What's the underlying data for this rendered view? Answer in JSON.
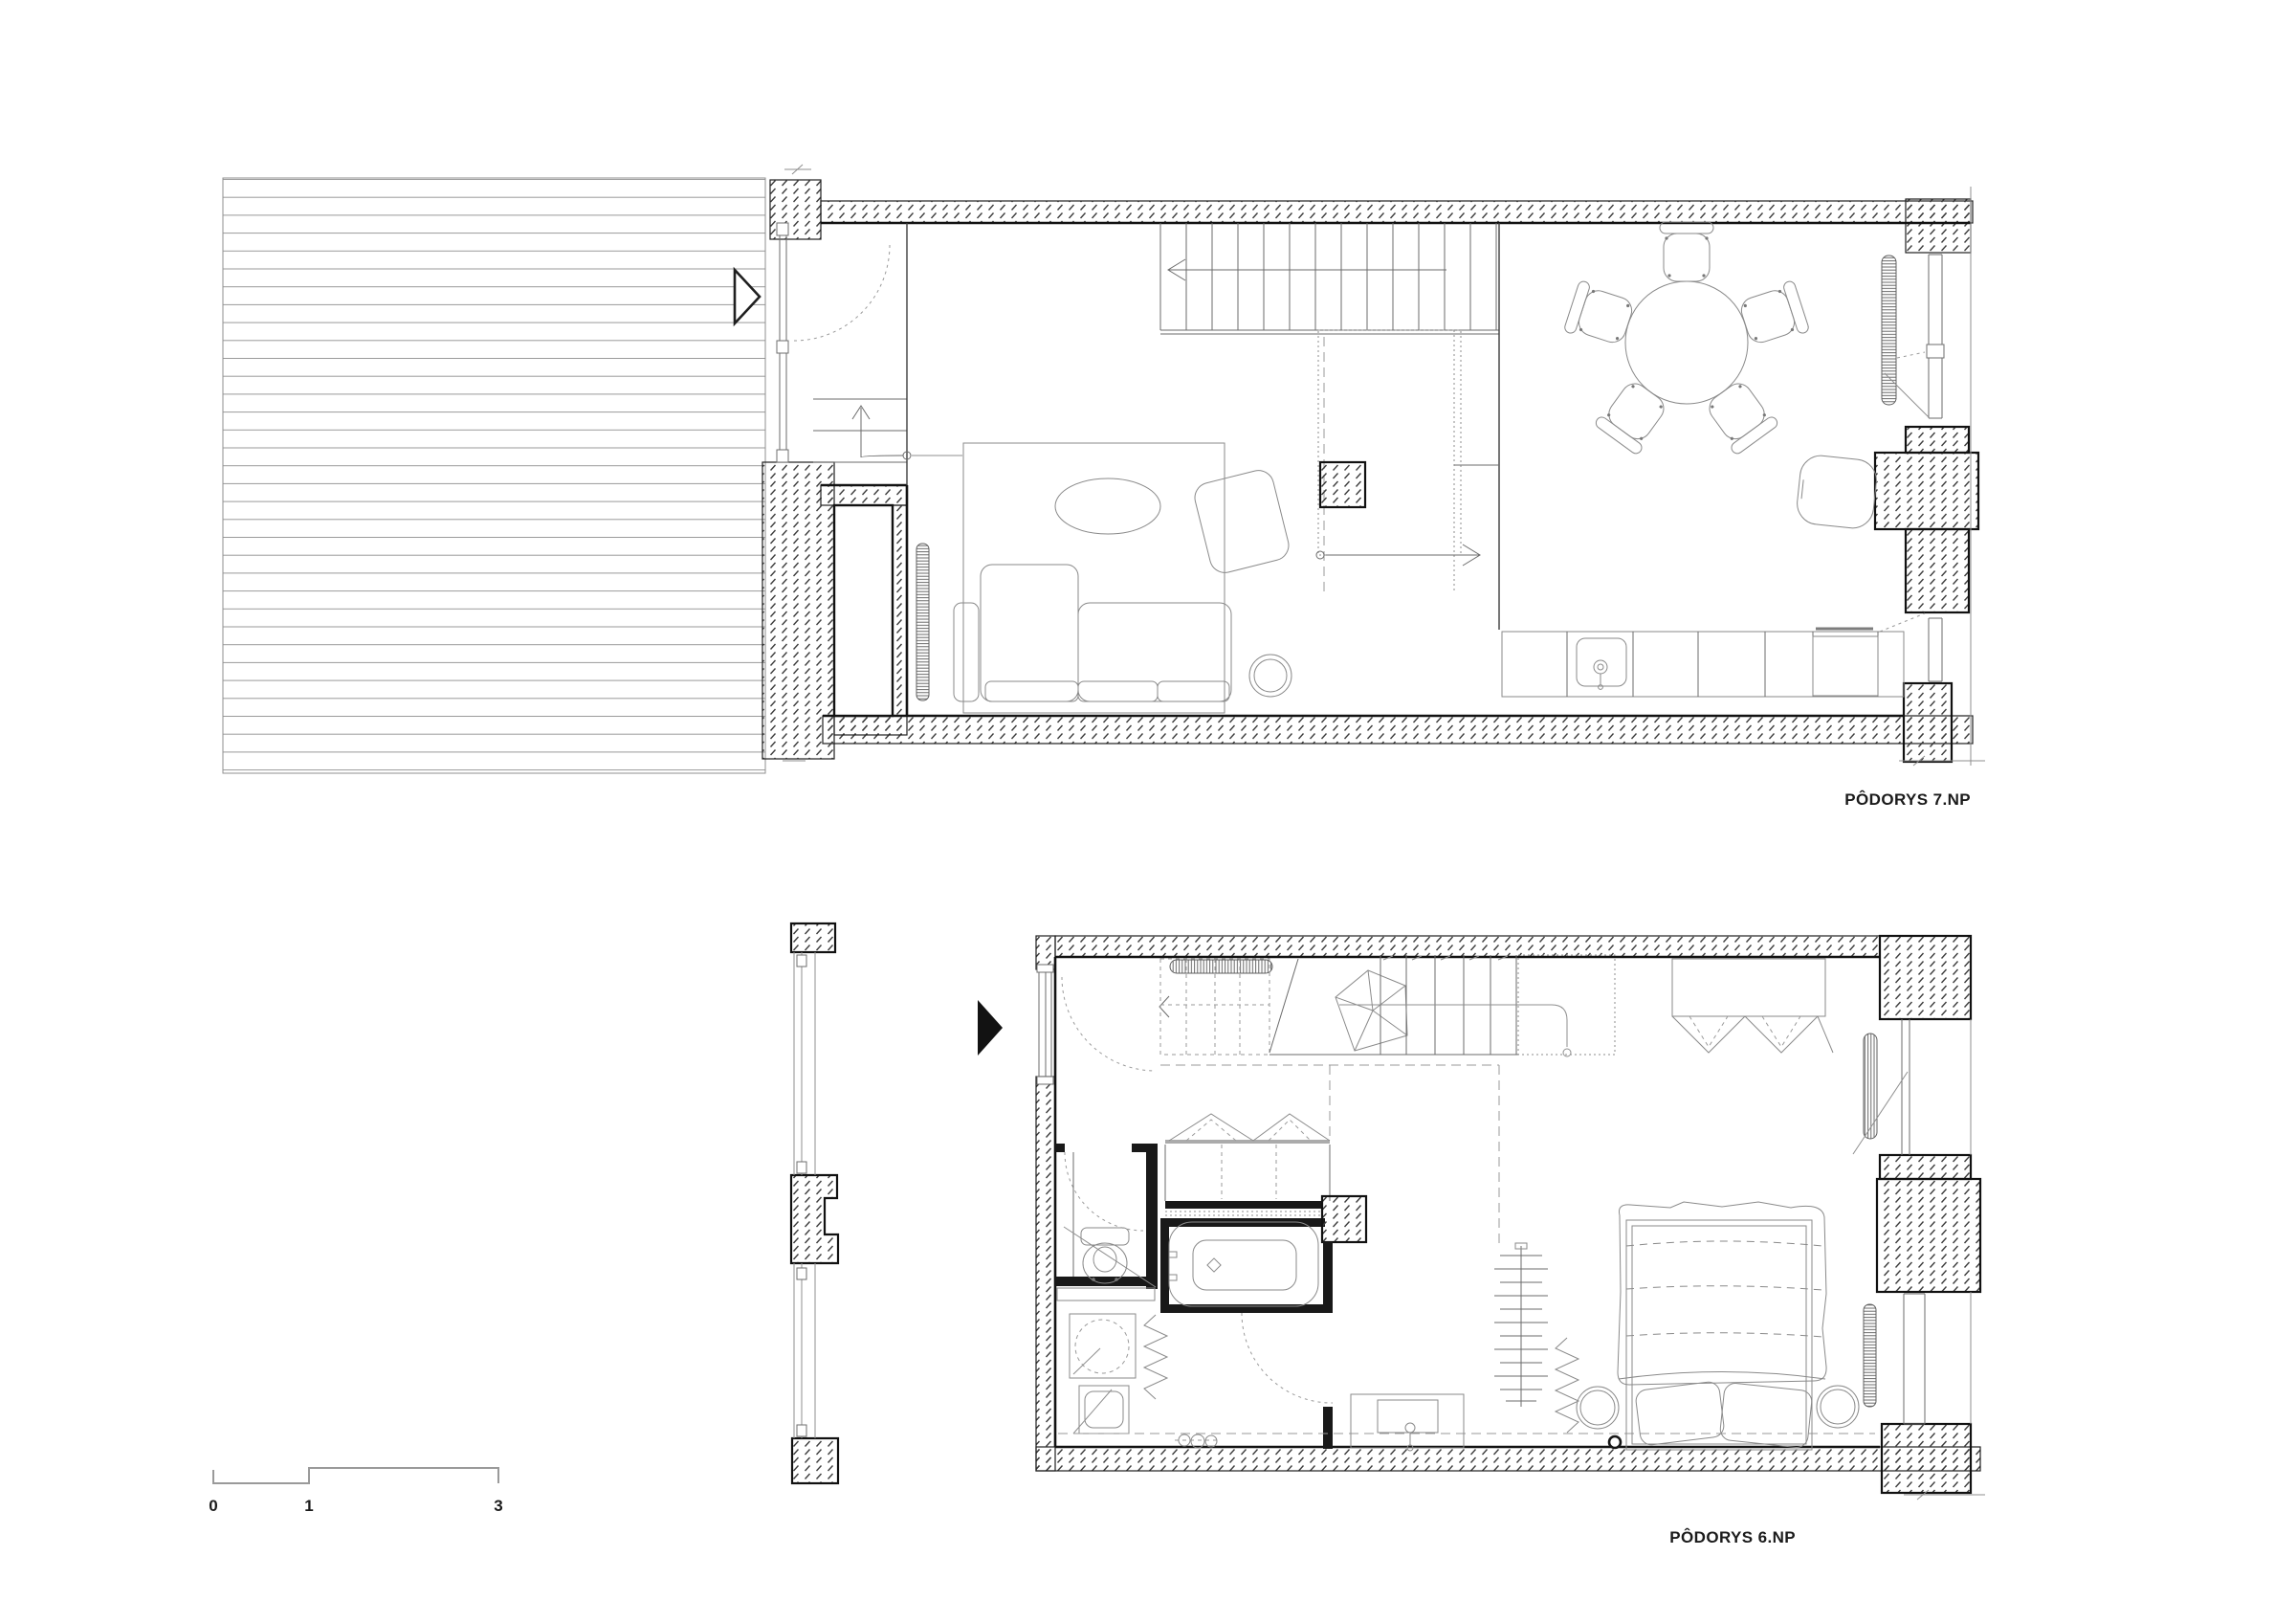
{
  "document": {
    "kind": "architectural-floor-plan-sheet",
    "background": "#ffffff",
    "ink": "#1a1a1a",
    "hatch_color": "#3d3d3d"
  },
  "plans": [
    {
      "title": "PÔDORYS 7.NP"
    },
    {
      "title": "PÔDORYS 6.NP"
    }
  ],
  "scale_bar": {
    "ticks": [
      "0",
      "1",
      "3"
    ]
  }
}
